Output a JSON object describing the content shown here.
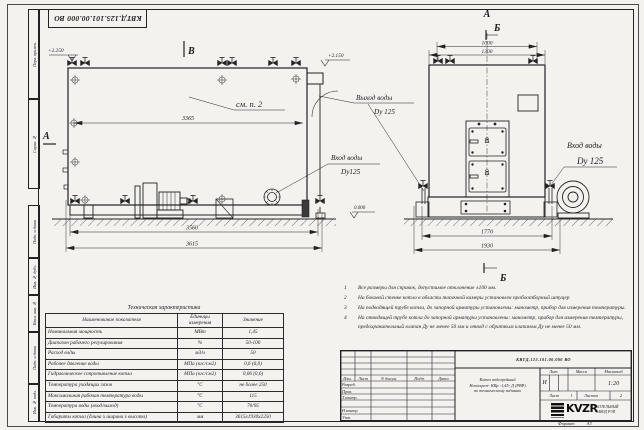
{
  "colors": {
    "paper": "#f3f2ef",
    "ink": "#222222"
  },
  "doc": {
    "number": "КВТД.125.101.00.000  ВО"
  },
  "margin_labels": [
    "Перв. примен.",
    "Справ. №",
    "Подп. и дата",
    "Инв. № дубл.",
    "Взам. инв. №",
    "Подп. и дата",
    "Инв. № подл."
  ],
  "side_view": {
    "view_label": "В",
    "section_label": "А",
    "see_note": "см. п. 2",
    "elev_left": "+2.250",
    "elev_right": "+2.150",
    "elev_zero": "0.000",
    "dim_inner": "3365",
    "dim_base": "3560",
    "dim_total": "3615",
    "outlet_line1": "Выход воды",
    "outlet_line2": "Dy 125",
    "inlet_line1": "Вход воды",
    "inlet_line2": "Dy125"
  },
  "front_view": {
    "section_a": "А",
    "section_b": "Б",
    "section_b_bottom": "Б",
    "dim_top_inner": "1000",
    "dim_top_outer": "1300",
    "dim_base": "1770",
    "dim_total": "1930",
    "inlet_line1": "Вход воды",
    "inlet_line2": "Dy 125"
  },
  "notes": {
    "items": [
      {
        "n": "1",
        "t": "Все размеры для справок, допустимое отклонение ±100 мм."
      },
      {
        "n": "2",
        "t": "На боковой стенке котла в области топочной камеры установлен пробоотборный штуцер"
      },
      {
        "n": "3",
        "t": "На  подводящей трубе котла, до запорной арматуры установлены: манометр, прибор для измерения температуры."
      },
      {
        "n": "4",
        "t": "На отводящей трубе котла до запорной арматуры установлены: манометр, прибор для измерения температуры, предохранительный клапан Ду не менее 50 мм и отвод с обратным клапаном Ду не менее 50 мм."
      }
    ]
  },
  "tech_table": {
    "title": "Техническая характеристика",
    "headers": [
      "Наименование показателя",
      "Единицы измерения",
      "Значение"
    ],
    "rows": [
      [
        "Номинальная мощность",
        "МВт",
        "1,45"
      ],
      [
        "Диапазон рабочего регулирования",
        "%",
        "50-100"
      ],
      [
        "Расход воды",
        "м3/ч",
        "50"
      ],
      [
        "Рабочее давление воды",
        "МПа (кгс/см2)",
        "0,6 (6,0)"
      ],
      [
        "Гидравлическое сопротивление котла",
        "МПа (кгс/см2)",
        "0,06 (0,6)"
      ],
      [
        "Температура уходящих газов",
        "°С",
        "не более 250"
      ],
      [
        "Максимальная рабочая температура воды",
        "°С",
        "115"
      ],
      [
        "Температура воды (вход/выход)",
        "°С",
        "70/95"
      ],
      [
        "Габариты котла (длина х ширина х высота)",
        "мм",
        "3615х1930х2250"
      ]
    ]
  },
  "title_block": {
    "cols": [
      "Изм.",
      "Лист",
      "N докум.",
      "Подп.",
      "Дата"
    ],
    "sign_rows": [
      "Разраб.",
      "Пров.",
      "Т.контр.",
      "Н.контр.",
      "Утв."
    ],
    "name_line1": "Котел водогрейный",
    "name_line2": "Heatexpert- КВр -1,45- Д (РВР)",
    "name_line3": "по техническому заданию",
    "lit_header": "Лит.",
    "lit_value": "И",
    "mass_header": "Масса",
    "scale_header": "Масштаб",
    "scale_value": "1:20",
    "sheet_label": "Лист",
    "sheet_value": "1",
    "sheets_label": "Листов",
    "sheets_value": "2",
    "logo_text": "KVZR",
    "logo_caption1": "КОТЕЛЬНЫЙ",
    "logo_caption2": "ЗАВОД РЭП",
    "format_label": "Формат",
    "format_value": "А3"
  }
}
